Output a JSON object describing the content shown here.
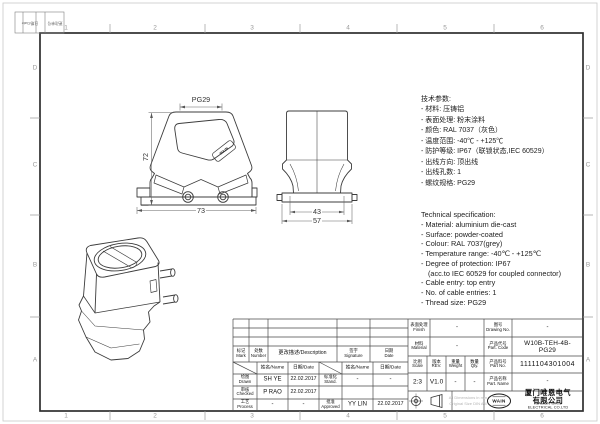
{
  "sheet": {
    "zones_h": [
      "1",
      "2",
      "3",
      "4",
      "5",
      "6"
    ],
    "zones_v": [
      "D",
      "C",
      "B",
      "A"
    ],
    "corner": {
      "date": "日期/Date",
      "change_no": "更改单号"
    }
  },
  "drawing": {
    "dims": {
      "front_height": "72",
      "front_width": "73",
      "thread": "PG29",
      "side_inner": "43",
      "side_outer": "57"
    },
    "front_logo": "WAIN"
  },
  "specs_cn": {
    "lines": [
      "技术参数:",
      "- 材料: 压铸铝",
      "- 表面处理: 粉末涂料",
      "- 颜色: RAL 7037（灰色）",
      "- 温度范围: -40℃ - +125℃",
      "- 防护等级: IP67（联锁状态,IEC 60529）",
      "- 出线方向: 顶出线",
      "- 出线孔数: 1",
      "- 螺纹规格: PG29"
    ]
  },
  "specs_en": {
    "lines": [
      "Technical specification:",
      "- Material: aluminium die-cast",
      "- Surface: powder-coated",
      "- Colour: RAL 7037(grey)",
      "- Temperature range: -40℃ - +125℃",
      "- Degree of protection: IP67",
      "(acc.to IEC 60529 for coupled connector)",
      "- Cable entry: top entry",
      "- No. of cable entries: 1",
      "- Thread size: PG29"
    ]
  },
  "tb": {
    "h_mark": "标记\nMark",
    "h_number": "处数\nNumber",
    "h_desc": "更改描述/Description",
    "h_sign": "签字\nSignature",
    "h_date": "日期\nDate",
    "sub_name": "姓名/Name",
    "sub_date": "日期/Date",
    "drawn": {
      "role": "绘图\nDrawn",
      "name": "SH YE",
      "date": "22.02.2017"
    },
    "checked": {
      "role": "审核\nChecked",
      "name": "P RAO",
      "date": "22.02.2017"
    },
    "process": {
      "role": "工艺\nProcess",
      "name": "-",
      "date": "-"
    },
    "stand": {
      "role": "标准化\nStand.",
      "name": "-",
      "date": "-"
    },
    "approved": {
      "role": "批准\nApproved",
      "name": "YY LIN",
      "date": "22.02.2017"
    },
    "finish": {
      "label": "表面处理\nFinish",
      "value": "-"
    },
    "material": {
      "label": "材料\nMaterial",
      "value": "-"
    },
    "scale": {
      "label": "比例\nScale",
      "value": "2:3"
    },
    "rev": {
      "label": "版本\nREV.",
      "value": "V1.0"
    },
    "weight": {
      "label": "重量\nWeight",
      "value": "-"
    },
    "qty": {
      "label": "数量\nQty.",
      "value": "-"
    },
    "drawing_no": {
      "label": "图号\nDrawing No.",
      "value": "-"
    },
    "part_code": {
      "label": "产品代号\nPart. Code",
      "value": "W10B-TEH-4B-PG29"
    },
    "part_no": {
      "label": "产品料号\nPart No.",
      "value": "1111104301004"
    },
    "part_name": {
      "label": "产品名称\nPart. Name",
      "value": "-"
    },
    "note": "All Dimensions in mm\nOriginal Size DIN A 4",
    "company": {
      "logo": "WAIN",
      "cn": "厦门唯恩电气有限公司",
      "en": "XIAMEN WAIN ELECTRICAL CO.LTD"
    }
  }
}
